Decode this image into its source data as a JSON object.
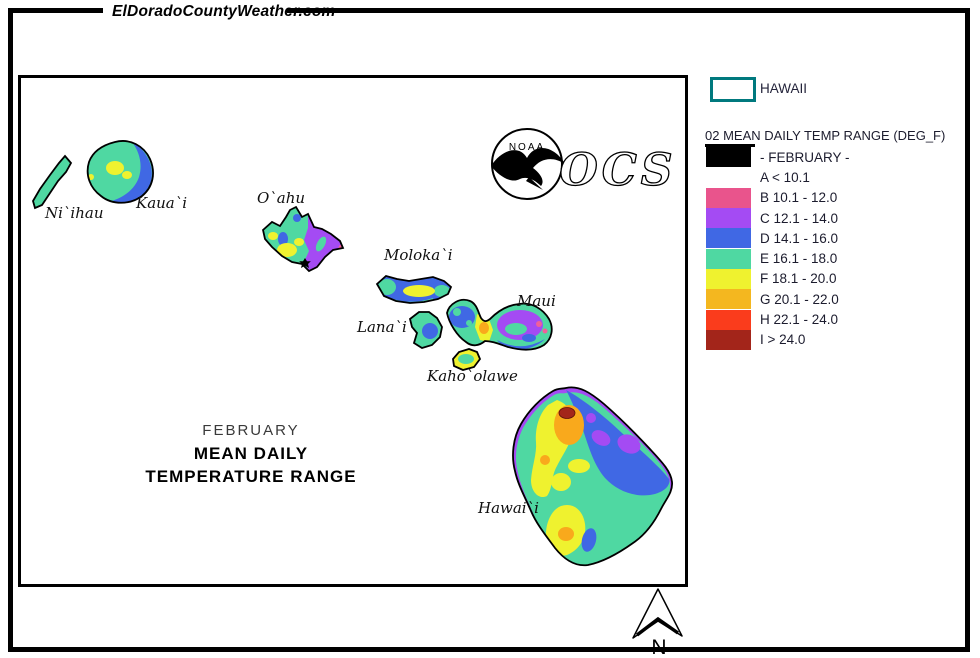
{
  "header": {
    "site_title": "ElDoradoCountyWeather.com"
  },
  "map": {
    "title": {
      "line1": "FEBRUARY",
      "line2": "MEAN DAILY",
      "line3": "TEMPERATURE RANGE"
    },
    "island_labels": [
      "Ni`ihau",
      "Kaua`i",
      "O`ahu",
      "Moloka`i",
      "Lana`i",
      "Maui",
      "Kaho`olawe",
      "Hawai`i"
    ],
    "noaa_logo_text": "NOAA",
    "ocs_logo_text": "OCS",
    "north_arrow_label": "N"
  },
  "legend": {
    "region": {
      "label": "HAWAII",
      "box_border_color": "#00797E"
    },
    "title": "02 MEAN DAILY TEMP RANGE (DEG_F)",
    "entries": [
      {
        "label": "- FEBRUARY -",
        "color": "#000000"
      },
      {
        "label": "A < 10.1",
        "color": null
      },
      {
        "label": "B 10.1 - 12.0",
        "color": "#E9548C"
      },
      {
        "label": "C 12.1 - 14.0",
        "color": "#A44BF3"
      },
      {
        "label": "D 14.1 - 16.0",
        "color": "#4068E4"
      },
      {
        "label": "E 16.1 - 18.0",
        "color": "#4FD8A2"
      },
      {
        "label": "F 18.1 - 20.0",
        "color": "#EFF22F"
      },
      {
        "label": "G 20.1 - 22.0",
        "color": "#F4B71F"
      },
      {
        "label": "H 22.1 - 24.0",
        "color": "#FA3C1C"
      },
      {
        "label": "I > 24.0",
        "color": "#A3251A"
      }
    ]
  }
}
